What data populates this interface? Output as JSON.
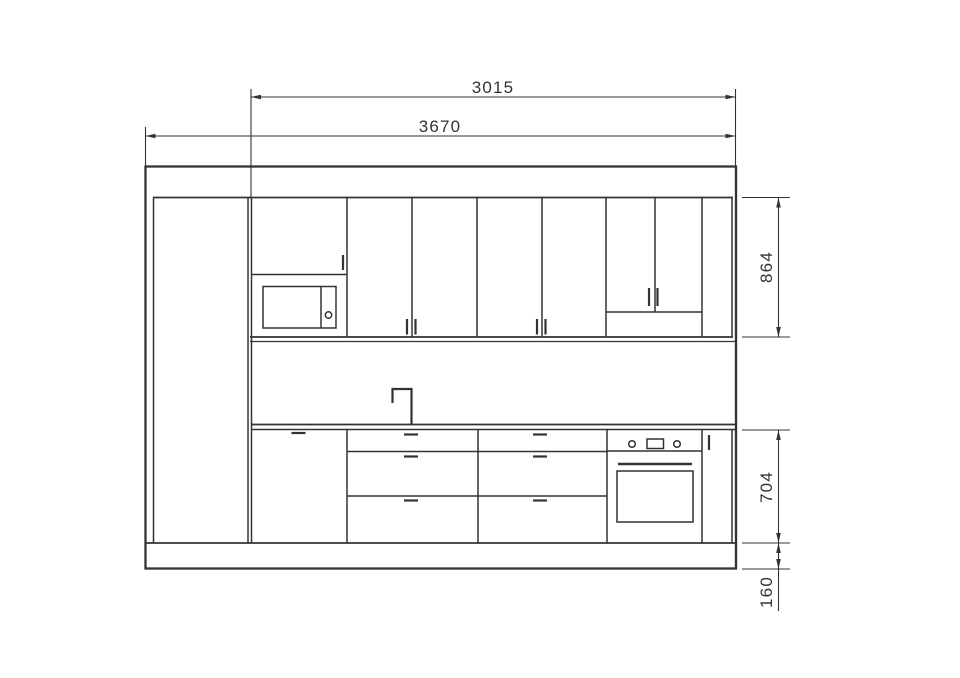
{
  "canvas": {
    "width": 960,
    "height": 678,
    "background": "#ffffff",
    "line_color": "#333333"
  },
  "drawing_type": "kitchen-elevation-line-drawing",
  "dimensions": {
    "run_width": "3015",
    "total_width": "3670",
    "upper_height": "864",
    "base_height": "704",
    "plinth_height": "160"
  },
  "components": [
    "room-wall-outline",
    "tall-cabinet",
    "wall-cabinet-doors",
    "cabinet-above-microwave",
    "microwave",
    "open-shelf-niche",
    "end-filler-panel",
    "worktop",
    "mixer-tap",
    "appliance-door",
    "drawer-stack-left",
    "drawer-stack-right",
    "built-in-oven",
    "narrow-base-door",
    "plinth"
  ]
}
